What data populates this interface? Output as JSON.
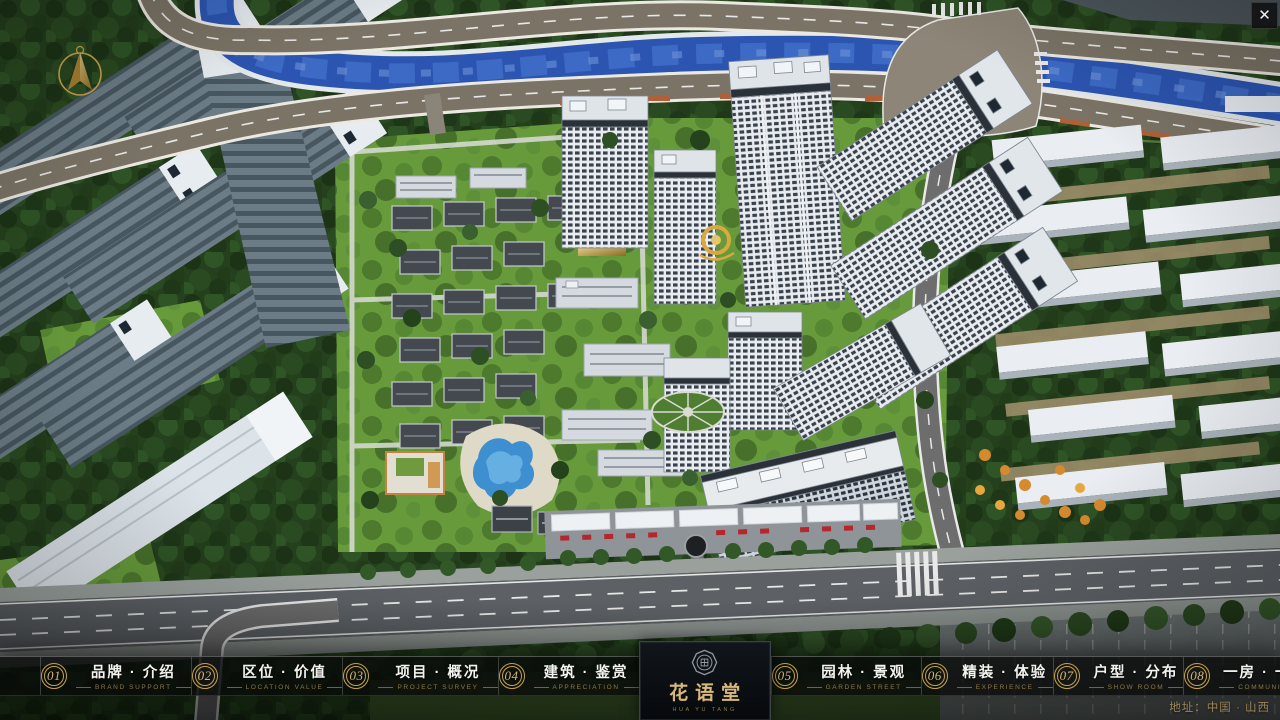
{
  "theme": {
    "gold": "#c9a24a",
    "gold-text": "#d8b77a",
    "gold-dim": "#8f7748",
    "nav-bg": "rgba(8,10,9,0.78)",
    "panel-bg": "#0b0f13",
    "address-gold": "#a88f5e"
  },
  "window": {
    "close_glyph": "✕"
  },
  "nav": {
    "items": [
      {
        "num": "01",
        "label": "品牌 · 介绍",
        "sub": "BRAND SUPPORT"
      },
      {
        "num": "02",
        "label": "区位 · 价值",
        "sub": "LOCATION VALUE"
      },
      {
        "num": "03",
        "label": "项目 · 概况",
        "sub": "PROJECT SURVEY"
      },
      {
        "num": "04",
        "label": "建筑 · 鉴赏",
        "sub": "APPRECIATION"
      },
      {
        "num": "05",
        "label": "园林 · 景观",
        "sub": "GARDEN STREET"
      },
      {
        "num": "06",
        "label": "精装 · 体验",
        "sub": "EXPERIENCE"
      },
      {
        "num": "07",
        "label": "户型 · 分布",
        "sub": "SHOW ROOM"
      },
      {
        "num": "08",
        "label": "一房 · 一景",
        "sub": "COMMUNITY"
      }
    ]
  },
  "logo": {
    "name": "花语堂",
    "sub": "HUA YU TANG"
  },
  "footer": {
    "address": "地址：中国 · 山西"
  }
}
